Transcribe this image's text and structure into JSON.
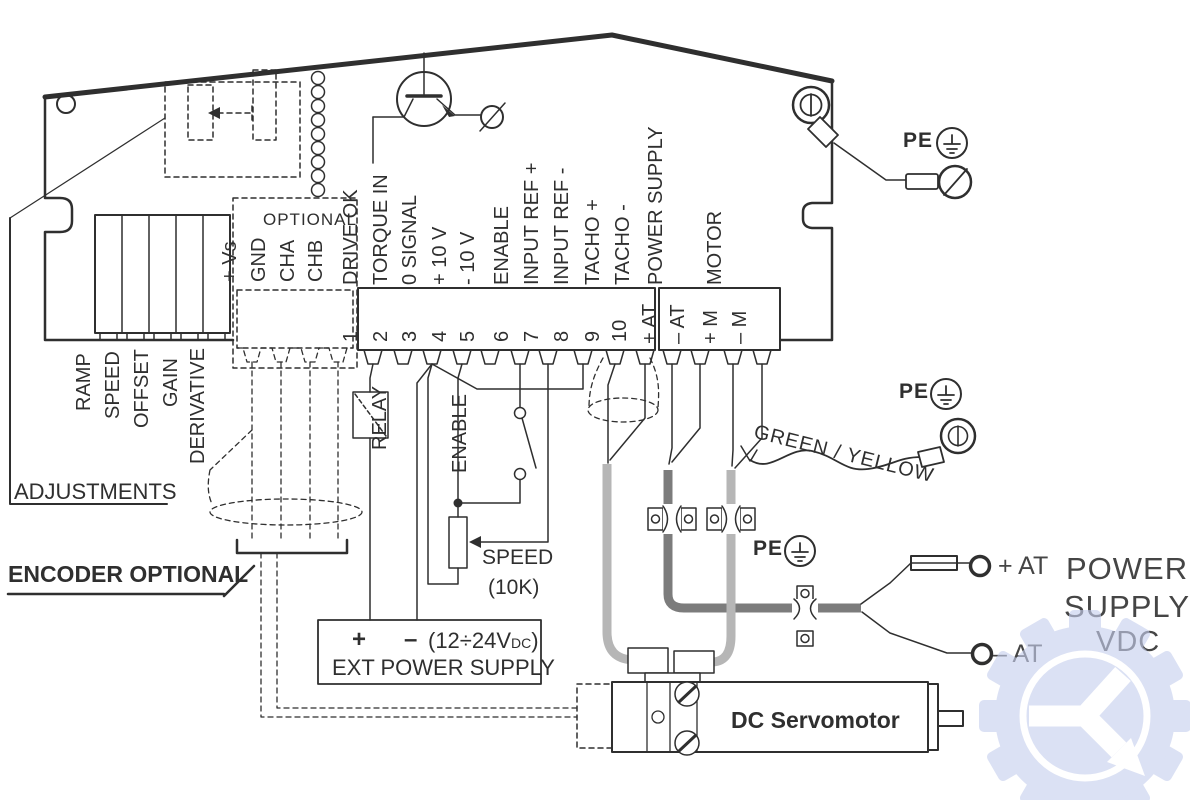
{
  "adjustments": {
    "title": "ADJUSTMENTS",
    "pots": [
      "RAMP",
      "SPEED",
      "OFFSET",
      "GAIN",
      "DERIVATIVE"
    ]
  },
  "encoder": {
    "title": "OPTIONAL",
    "pins": [
      "+ Vs",
      "GND",
      "CHA",
      "CHB"
    ],
    "note": "ENCODER OPTIONAL"
  },
  "terminals": [
    {
      "num": "1",
      "label": "DRIVE OK"
    },
    {
      "num": "2",
      "label": "TORQUE IN"
    },
    {
      "num": "3",
      "label": "0 SIGNAL"
    },
    {
      "num": "4",
      "label": "+ 10 V"
    },
    {
      "num": "5",
      "label": "- 10 V"
    },
    {
      "num": "6",
      "label": "ENABLE"
    },
    {
      "num": "7",
      "label": "INPUT REF +"
    },
    {
      "num": "8",
      "label": "INPUT REF -"
    },
    {
      "num": "9",
      "label": "TACHO +"
    },
    {
      "num": "10",
      "label": "TACHO -"
    }
  ],
  "power_terminals": {
    "group": "POWER SUPPLY",
    "pins": [
      "+ AT",
      "– AT"
    ]
  },
  "motor_terminals": {
    "group": "MOTOR",
    "pins": [
      "+ M",
      "– M"
    ]
  },
  "relay_label": "RELAY",
  "enable_label": "ENABLE",
  "speed_label": "SPEED",
  "speed_value": "(10K)",
  "ext_supply": {
    "plus": "+",
    "minus": "–",
    "rating": "(12÷24V",
    "rating_sub": "DC",
    "rating_end": ")",
    "title": "EXT POWER SUPPLY"
  },
  "pe_label": "PE",
  "wire_label": "GREEN / YELLOW",
  "supply": {
    "line1": "POWER",
    "line2": "SUPPLY",
    "line3": "VDC",
    "plus": "+ AT",
    "minus": "– AT"
  },
  "motor_label": "DC Servomotor",
  "colors": {
    "line": "#2f2f2f",
    "cable_light": "#b6b6b6",
    "cable_dark": "#7c7c7c",
    "watermark": "#c6cfee"
  }
}
